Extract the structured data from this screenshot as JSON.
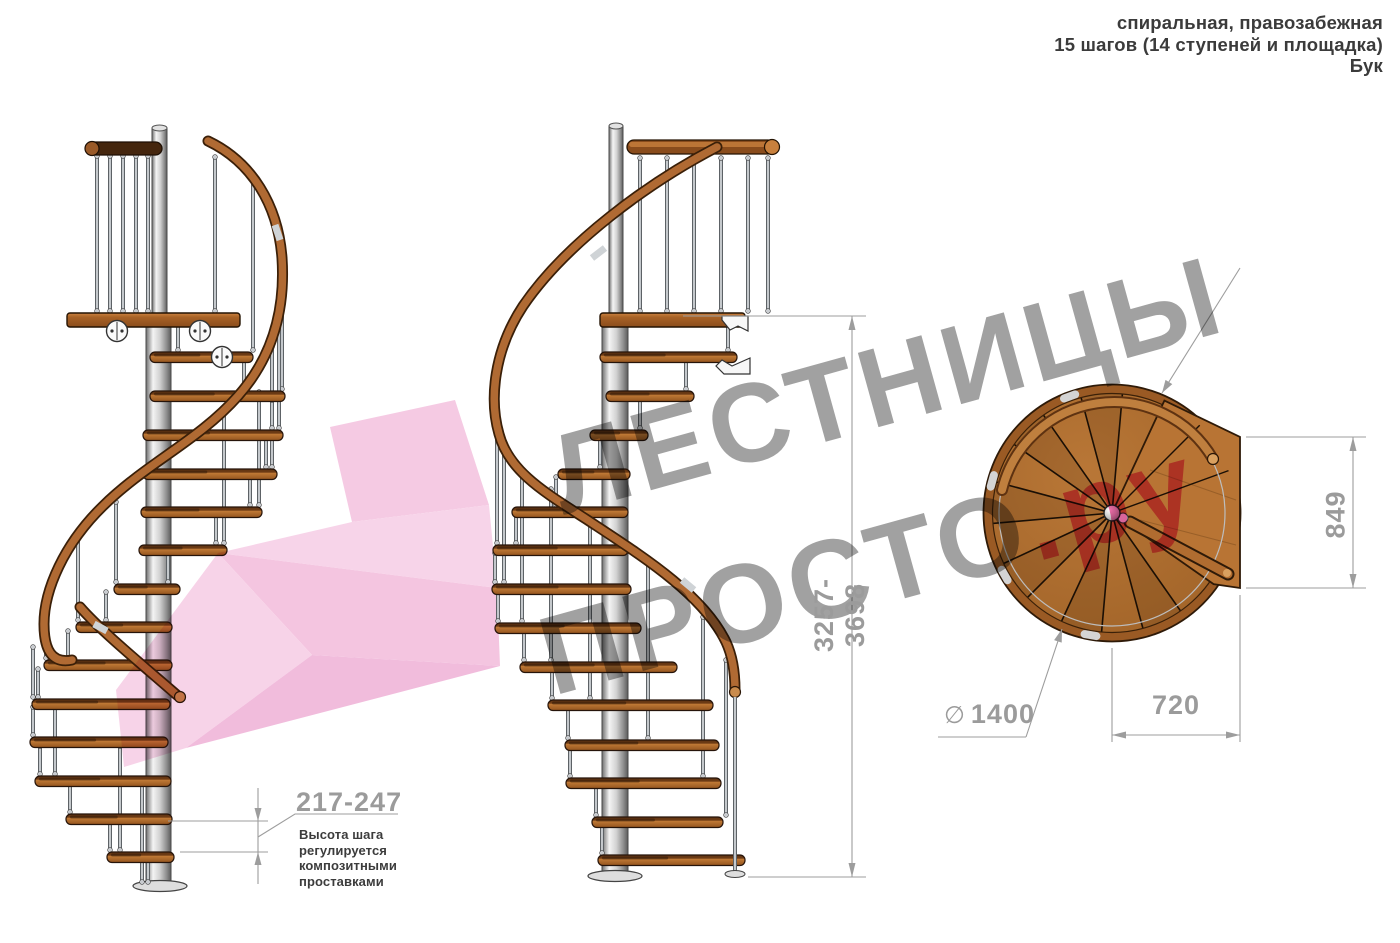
{
  "header": {
    "line1": "спиральная, правозабежная",
    "line2": "15 шагов (14 ступеней и площадка)",
    "line3": "Бук"
  },
  "watermark": {
    "word1": "ЛЕСТНИЦЫ",
    "word2": "ПРОСТО",
    "suffix": ".ру"
  },
  "dimensions": {
    "total_height": "3257-3698",
    "step_height": "217-247",
    "step_height_note": "Высота шага регулируется композитными проставками",
    "landing_depth": "849",
    "landing_width": "720",
    "diameter_symbol": "∅",
    "diameter": "1400"
  },
  "colors": {
    "accent_pink": "#ec4f97",
    "watermark_gray": "#949494",
    "dimension_gray": "#9b9b9b",
    "wood_light": "#b4671f",
    "wood_dark": "#5f3312",
    "metal": "#d8d8d8"
  }
}
